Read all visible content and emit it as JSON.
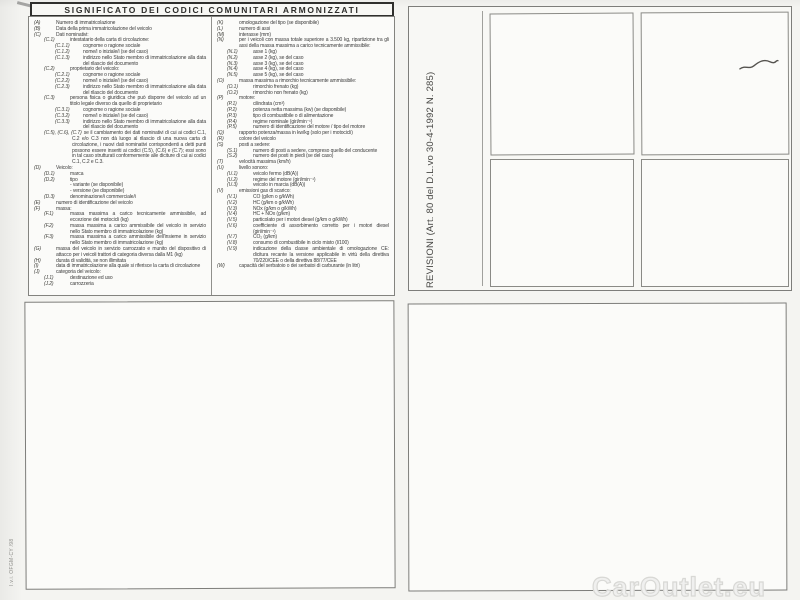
{
  "document": {
    "title": "SIGNIFICATO DEI CODICI COMUNITARI ARMONIZZATI",
    "revisioni_label": "REVISIONI (Art. 80 del D.L.vo 30-4-1992 N. 285)",
    "print_code": "I.v.i. OFGM-CY /98",
    "watermark": "CarOutlet.eu"
  },
  "colors": {
    "paper": "#f4f4f1",
    "box_fill": "#fbfbf9",
    "border": "#7d7d7a",
    "title_border": "#2f2f2d",
    "ink": "#3b3b3b",
    "watermark": "#d8d8d5"
  },
  "legend": {
    "left_column": [
      {
        "code": "(A)",
        "text": "Numero di immatricolazione",
        "indent": 0
      },
      {
        "code": "(B)",
        "text": "Data della prima immatricolazione del veicolo",
        "indent": 0
      },
      {
        "code": "(C)",
        "text": "Dati nominativi:",
        "indent": 0
      },
      {
        "code": "(C.1)",
        "text": "intestatario della carta di circolazione:",
        "indent": 1
      },
      {
        "code": "(C.1.1)",
        "text": "cognome o ragione sociale",
        "indent": 2
      },
      {
        "code": "(C.1.2)",
        "text": "nome/i o iniziale/i (se del caso)",
        "indent": 2
      },
      {
        "code": "(C.1.3)",
        "text": "indirizzo nello Stato membro di immatricolazione alla data del rilascio del documento",
        "indent": 2
      },
      {
        "code": "(C.2)",
        "text": "proprietario del veicolo:",
        "indent": 1
      },
      {
        "code": "(C.2.1)",
        "text": "cognome o ragione sociale",
        "indent": 2
      },
      {
        "code": "(C.2.2)",
        "text": "nome/i o iniziale/i (se del caso)",
        "indent": 2
      },
      {
        "code": "(C.2.3)",
        "text": "indirizzo nello Stato membro di immatricolazione alla data del rilascio del documento",
        "indent": 2
      },
      {
        "code": "(C.3)",
        "text": "persona fisica o giuridica che può disporre del veicolo ad un titolo legale diverso da quello di proprietario",
        "indent": 1
      },
      {
        "code": "(C.3.1)",
        "text": "cognome o ragione sociale",
        "indent": 2
      },
      {
        "code": "(C.3.2)",
        "text": "nome/i o iniziale/i (se del caso)",
        "indent": 2
      },
      {
        "code": "(C.3.3)",
        "text": "indirizzo nello Stato membro di immatricolazione alla data del rilascio del documento",
        "indent": 2
      },
      {
        "code": "(C.5), (C.6), (C.7)",
        "text": "se il cambiamento dei dati nominativi di cui ai codici C.1, C.2 e/o C.3 non dà luogo al rilascio di una nuova carta di circolazione, i nuovi dati nominativi corrispondenti a detti punti possono essere inseriti ai codici (C.5), (C.6) e (C.7); essi sono in tal caso strutturati conformemente alle diciture di cui ai codici C.1, C.2 e C.3.",
        "indent": 1
      },
      {
        "code": "(D)",
        "text": "Veicolo:",
        "indent": 0
      },
      {
        "code": "(D.1)",
        "text": "marca",
        "indent": 1
      },
      {
        "code": "(D.2)",
        "text": "tipo",
        "indent": 1
      },
      {
        "code": "",
        "text": "- variante (se disponibile)",
        "indent": 1
      },
      {
        "code": "",
        "text": "- versione (se disponibile)",
        "indent": 1
      },
      {
        "code": "(D.3)",
        "text": "denominazione/i commerciale/i",
        "indent": 1
      },
      {
        "code": "(E)",
        "text": "numero di identificazione del veicolo",
        "indent": 0
      },
      {
        "code": "(F)",
        "text": "massa:",
        "indent": 0
      },
      {
        "code": "(F.1)",
        "text": "massa massima a carico tecnicamente ammissibile, ad eccezione dei motocicli (kg)",
        "indent": 1
      },
      {
        "code": "(F.2)",
        "text": "massa massima a carico ammissibile del veicolo in servizio nello Stato membro di immatricolazione (kg)",
        "indent": 1
      },
      {
        "code": "(F.3)",
        "text": "massa massima a carico ammissibile dell'insieme in servizio nello Stato membro di immatricolazione (kg)",
        "indent": 1
      },
      {
        "code": "(G)",
        "text": "massa del veicolo in servizio carrozzato e munito del dispositivo di attacco per i veicoli trattori di categoria diversa dalla M1 (kg)",
        "indent": 0
      },
      {
        "code": "(H)",
        "text": "durata di validità, se non illimitata",
        "indent": 0
      },
      {
        "code": "(I)",
        "text": "data di immatricolazione alla quale si riferisce la carta di circolazione",
        "indent": 0
      },
      {
        "code": "(J)",
        "text": "categoria del veicolo:",
        "indent": 0
      },
      {
        "code": "(J.1)",
        "text": "destinazione ed uso",
        "indent": 1
      },
      {
        "code": "(J.2)",
        "text": "carrozzeria",
        "indent": 1
      }
    ],
    "right_column": [
      {
        "code": "(K)",
        "text": "omologazione del tipo (se disponibile)",
        "indent": 0
      },
      {
        "code": "(L)",
        "text": "numero di assi",
        "indent": 0
      },
      {
        "code": "(M)",
        "text": "interasse (mm)",
        "indent": 0
      },
      {
        "code": "(N)",
        "text": "per i veicoli con massa totale superiore a 3.500 kg, ripartizione tra gli assi della massa massima a carico tecnicamente ammissibile:",
        "indent": 0
      },
      {
        "code": "(N.1)",
        "text": "asse 1 (kg)",
        "indent": 1
      },
      {
        "code": "(N.2)",
        "text": "asse 2 (kg), se del caso",
        "indent": 1
      },
      {
        "code": "(N.3)",
        "text": "asse 3 (kg), se del caso",
        "indent": 1
      },
      {
        "code": "(N.4)",
        "text": "asse 4 (kg), se del caso",
        "indent": 1
      },
      {
        "code": "(N.5)",
        "text": "asse 5 (kg), se del caso",
        "indent": 1
      },
      {
        "code": "(O)",
        "text": "massa massima a rimorchio tecnicamente ammissibile:",
        "indent": 0
      },
      {
        "code": "(O.1)",
        "text": "rimorchio frenato (kg)",
        "indent": 1
      },
      {
        "code": "(O.2)",
        "text": "rimorchio non frenato (kg)",
        "indent": 1
      },
      {
        "code": "(P)",
        "text": "motore:",
        "indent": 0
      },
      {
        "code": "(P.1)",
        "text": "cilindrata (cm³)",
        "indent": 1
      },
      {
        "code": "(P.2)",
        "text": "potenza netta massima (kw) (se disponibile)",
        "indent": 1
      },
      {
        "code": "(P.3)",
        "text": "tipo di combustibile o di alimentazione",
        "indent": 1
      },
      {
        "code": "(P.4)",
        "text": "regime nominale (giri/min⁻¹)",
        "indent": 1
      },
      {
        "code": "(P.5)",
        "text": "numero di identificazione del motore / tipo del motore",
        "indent": 1
      },
      {
        "code": "(Q)",
        "text": "rapporto potenza/massa in kw/kg (solo per i motocicli)",
        "indent": 0
      },
      {
        "code": "(R)",
        "text": "colore del veicolo",
        "indent": 0
      },
      {
        "code": "(S)",
        "text": "posti a sedere:",
        "indent": 0
      },
      {
        "code": "(S.1)",
        "text": "numero di posti a sedere, compreso quello del conducente",
        "indent": 1
      },
      {
        "code": "(S.2)",
        "text": "numero dei posti in piedi (se del caso)",
        "indent": 1
      },
      {
        "code": "(T)",
        "text": "velocità massima (km/h)",
        "indent": 0
      },
      {
        "code": "(U)",
        "text": "livello sonoro:",
        "indent": 0
      },
      {
        "code": "(U.1)",
        "text": "veicolo fermo (dB(A))",
        "indent": 1
      },
      {
        "code": "(U.2)",
        "text": "regime del motore (giri/min⁻¹)",
        "indent": 1
      },
      {
        "code": "(U.3)",
        "text": "veicolo in marcia (dB(A))",
        "indent": 1
      },
      {
        "code": "(V)",
        "text": "emissioni gas di scarico:",
        "indent": 0
      },
      {
        "code": "(V.1)",
        "text": "CO (g/km o g/kWh)",
        "indent": 1
      },
      {
        "code": "(V.2)",
        "text": "HC (g/km o g/kWh)",
        "indent": 1
      },
      {
        "code": "(V.3)",
        "text": "NOx (g/km o g/kWh)",
        "indent": 1
      },
      {
        "code": "(V.4)",
        "text": "HC + NOx (g/km)",
        "indent": 1
      },
      {
        "code": "(V.5)",
        "text": "particolato per i motori diesel (g/km o g/kWh)",
        "indent": 1
      },
      {
        "code": "(V.6)",
        "text": "coefficiente di assorbimento corretto per i motori diesel (giri/min⁻¹)",
        "indent": 1
      },
      {
        "code": "(V.7)",
        "text": "CO₂ (g/km)",
        "indent": 1
      },
      {
        "code": "(V.8)",
        "text": "consumo di combustibile in ciclo misto (l/100)",
        "indent": 1
      },
      {
        "code": "(V.9)",
        "text": "indicazione della classe ambientale di omologazione CE: dicitura recante la versione applicabile in virtù della direttiva 70/220/CEE o della direttiva 88/77/CEE",
        "indent": 1
      },
      {
        "code": "(W)",
        "text": "capacità del serbatoio o dei serbatoi di carburante (in litri)",
        "indent": 0
      }
    ]
  }
}
